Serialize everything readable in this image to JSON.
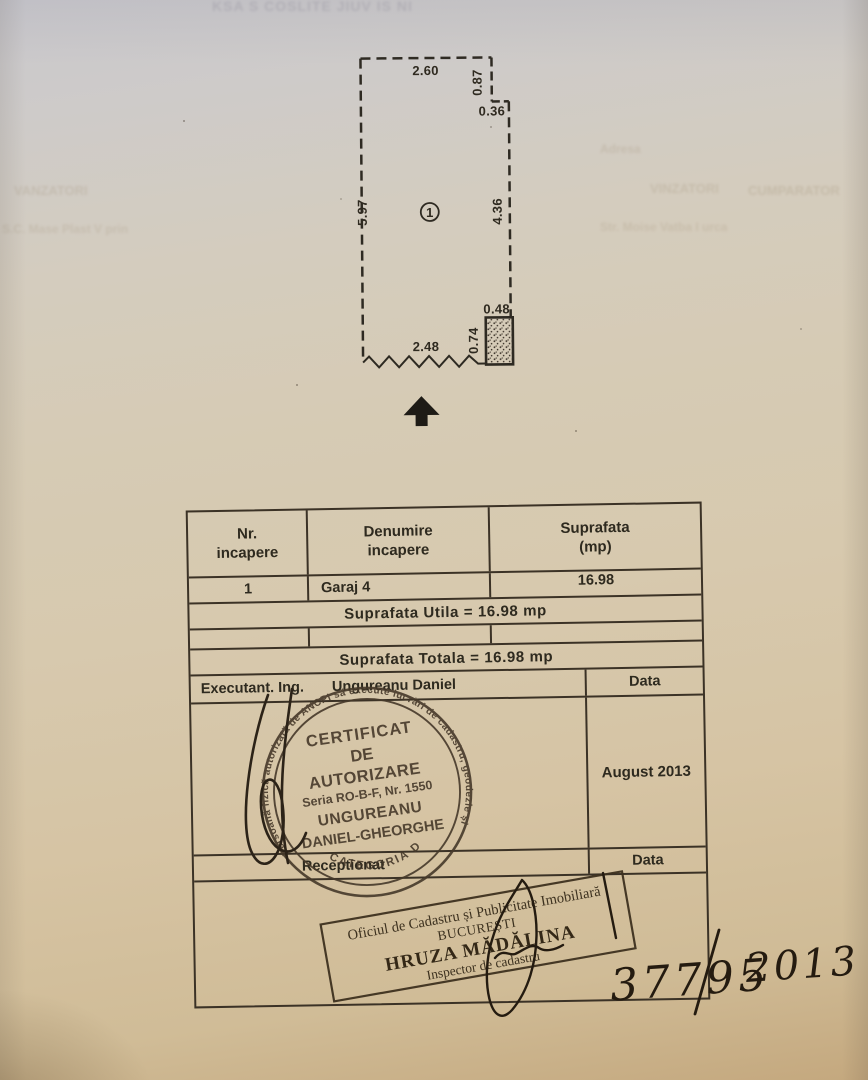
{
  "page": {
    "bleedthrough": {
      "top": "KSA S COSLITE JIUV IS NI",
      "adresa": "Adresa",
      "left_line1": "VANZATORI",
      "left_line2": "S.C. Mase Plast V prin",
      "right_line1": "VINZATORI",
      "right_line2": "CUMPARATOR",
      "right_line3": "Str. Moise Vatba I urca"
    }
  },
  "plan": {
    "room_label": "1",
    "dim_top": "2.60",
    "dim_right_upper": "0.87",
    "dim_step": "0.36",
    "dim_right_lower": "4.36",
    "dim_left": "5.97",
    "dim_bottom": "2.48",
    "dim_pillar_height": "0.74",
    "dim_pillar_width": "0.48"
  },
  "table": {
    "header": {
      "col1_line1": "Nr.",
      "col1_line2": "incapere",
      "col2_line1": "Denumire",
      "col2_line2": "incapere",
      "col3_line1": "Suprafata",
      "col3_line2": "(mp)"
    },
    "row1": {
      "nr": "1",
      "denumire": "Garaj  4",
      "suprafata": "16.98"
    },
    "suprafata_utila": "Suprafata  Utila  =  16.98  mp",
    "suprafata_totala": "Suprafata  Totala  =  16.98  mp",
    "executant_label": "Executant.  Ing.",
    "executant_name": "Ungureanu  Daniel",
    "data_label_executant": "Data",
    "executant_date": "August  2013",
    "receptionat_label": "Receptionat",
    "data_label_receptionat": "Data"
  },
  "round_stamp": {
    "ring_text": "Persoană fizică autorizată de ANCPI să execute lucrări de cadastru, geodezie și cartografie",
    "line1": "CERTIFICAT",
    "line2": "DE",
    "line3": "AUTORIZARE",
    "line4": "Seria RO-B-F, Nr. 1550",
    "line5": "UNGUREANU",
    "line6": "DANIEL-GHEORGHE",
    "bottom_arc": "CATEGORIA D"
  },
  "rect_stamp": {
    "line1": "Oficiul de Cadastru și Publicitate Imobiliară",
    "line2": "BUCUREȘTI",
    "line3": "HRUZA MĂDĂLINA",
    "line4": "Inspector de cadastru"
  },
  "handwriting": {
    "number": "37795",
    "year": "2013"
  }
}
